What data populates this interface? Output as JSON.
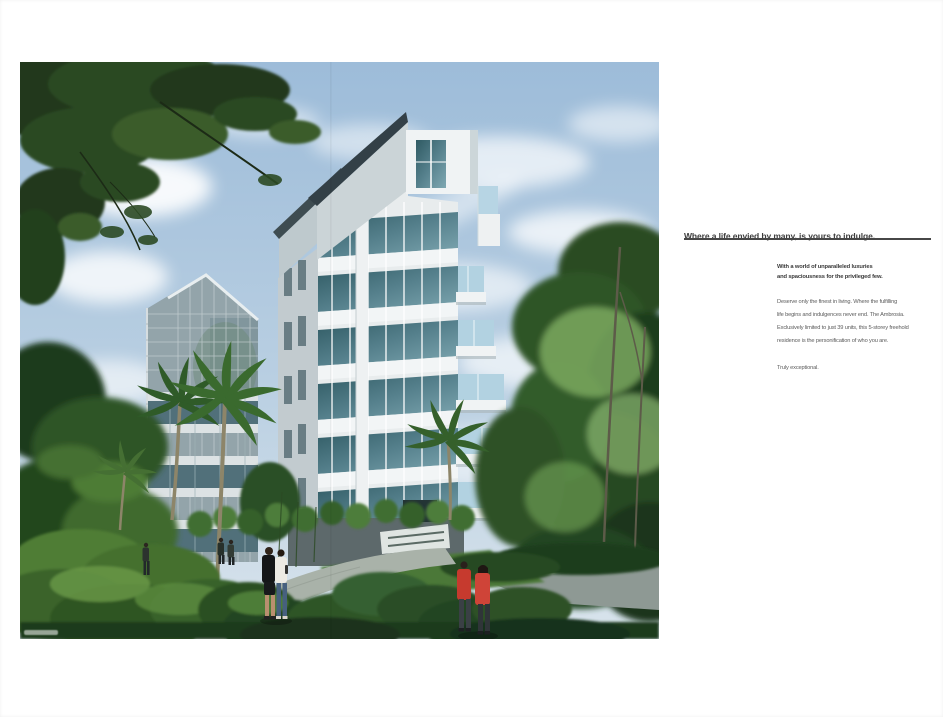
{
  "artwork": {
    "name": "condominium-rendering",
    "description": "Architectural rendering of a 5-storey white condominium tower amid lush tropical greenery, palms, winding footpath and strolling residents under a blue cloudy sky",
    "palette": {
      "sky_top": "#9dbcd9",
      "sky_low": "#d9e4ec",
      "cloud": "#ffffff",
      "canopy_dark": "#20371c",
      "foliage_mid": "#3f6b2f",
      "foliage_light": "#7fae63",
      "building_white": "#e8eced",
      "building_shadow": "#c2cbcf",
      "glass_teal": "#2f5a63",
      "balcony_glass": "#b2d2e1",
      "left_building_glass": "#93a4aa",
      "path_gray": "#a9b2a9",
      "road_gray": "#8e9994",
      "figure_red": "#c63a2e",
      "figure_black": "#141618",
      "figure_white_top": "#eceae4",
      "jeans_blue": "#46607e"
    }
  },
  "copy": {
    "headline": "Where a life envied by many, is yours to indulge.",
    "subhead_lines": [
      "With a world of unparalleled luxuries",
      "and spaciousness for the privileged few."
    ],
    "body_lines": [
      "Deserve only the finest in living. Where the fulfilling",
      "life begins and indulgences never end. The Ambrosia.",
      "Exclusively limited to just 39 units, this 5-storey freehold",
      "residence is the personification of who you are."
    ],
    "closing": "Truly exceptional."
  }
}
